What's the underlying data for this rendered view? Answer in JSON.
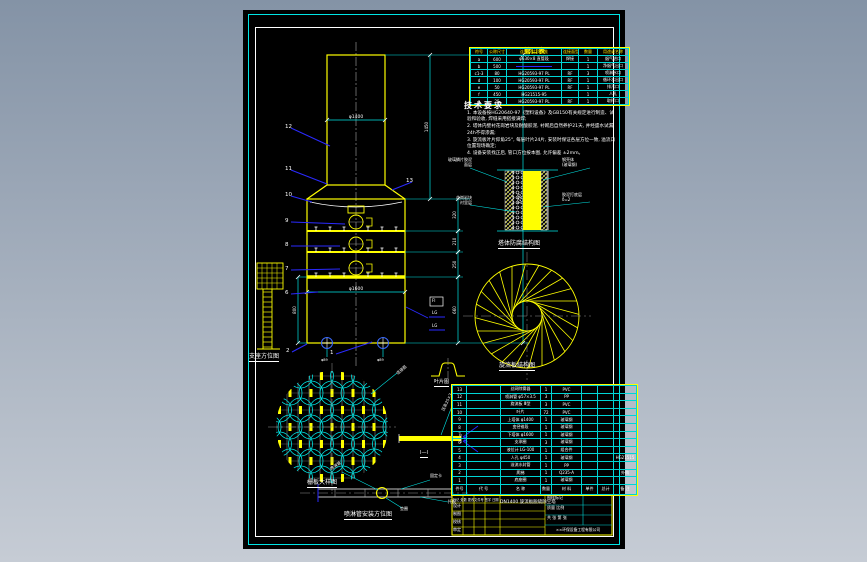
{
  "app": {
    "kind": "CAD drawing viewer",
    "sheet": "black drawing sheet with cyan/white frame"
  },
  "colors": {
    "line_yellow": "#ffff00",
    "line_cyan": "#00ffff",
    "line_white": "#ffffff",
    "leader_blue": "#2a2aff",
    "centerline_gray": "#909090",
    "bg_top": "#8493a6",
    "bg_bottom": "#c6ccd5"
  },
  "nozzle_table": {
    "title": "管口表",
    "headers": [
      "符号",
      "公称尺寸",
      "连接尺寸、标准",
      "连接面型式",
      "数量",
      "用途或名称"
    ],
    "rows": [
      [
        "a",
        "600",
        "φ630×8 直管段",
        "焊接",
        "1",
        "烟气进口"
      ],
      [
        "b",
        "500",
        "——",
        "",
        "1",
        "净烟气出口"
      ],
      [
        "c1-3",
        "80",
        "HG20593-97 PL",
        "RF",
        "3",
        "喷淋水口"
      ],
      [
        "d",
        "100",
        "HG20593-97 PL",
        "RF",
        "1",
        "循环水出口"
      ],
      [
        "e",
        "50",
        "HG20593-97 PL",
        "RF",
        "1",
        "排污口"
      ],
      [
        "f",
        "450",
        "HG21515-95",
        "",
        "1",
        "人孔"
      ],
      [
        "g",
        "25",
        "HG20593-97 PL",
        "RF",
        "1",
        "取样口"
      ]
    ]
  },
  "notes": {
    "title": "技术要求",
    "items": [
      "1. 本设备按HG20640-97《塑料设备》及GB150有关规定进行制造、试验和验收, 焊缝采用搭接满焊;",
      "2. 塔体内壁衬花岗岩块及耐酸胶泥, 衬砌后自然养护21天, 并经盛水试漏24h不得渗漏;",
      "3. 旋流板叶片仰角25°, 每层叶片24片, 安装时保证各层方位一致, 溢流口位置现场确定;",
      "4. 设备安装找正后, 管口方位按本图, 允许偏差 ±2mm。"
    ]
  },
  "lining_detail": {
    "caption": "塔体防腐结构图",
    "labels": [
      "玻璃鳞片胶泥,面层",
      "花岗岩块,衬里层",
      "钢壳体,(玻璃钢)",
      "胶泥打底层,δ=2"
    ]
  },
  "swirl": {
    "caption": "旋流板结构图",
    "blade_count": 24
  },
  "grid_plate": {
    "caption": "栅板大样图",
    "leader_label": "连接筋"
  },
  "vane_detail": {
    "caption": "叶片图"
  },
  "bar_detail": {
    "caption": "Ⅰ—Ⅰ",
    "leader_label": "压条25×3"
  },
  "pipe_detail": {
    "caption": "喷淋管安装方位图",
    "labels": {
      "upper_left": "喷淋管",
      "upper_right": "固定卡",
      "lower_right": "托板",
      "lower_left": "垫圈"
    }
  },
  "tower": {
    "base_caption": "支座方位图",
    "tags": [
      "FI",
      "LG",
      "LG"
    ],
    "leaders": [
      {
        "label": "12",
        "x": 285,
        "y": 124,
        "tx": 330,
        "ty": 146
      },
      {
        "label": "11",
        "x": 285,
        "y": 166,
        "tx": 327,
        "ty": 184
      },
      {
        "label": "10",
        "x": 285,
        "y": 192,
        "tx": 312,
        "ty": 202
      },
      {
        "label": "9",
        "x": 285,
        "y": 218,
        "tx": 345,
        "ty": 224
      },
      {
        "label": "8",
        "x": 285,
        "y": 242,
        "tx": 340,
        "ty": 246
      },
      {
        "label": "7",
        "x": 285,
        "y": 266,
        "tx": 340,
        "ty": 269
      },
      {
        "label": "6",
        "x": 285,
        "y": 290,
        "tx": 318,
        "ty": 292
      },
      {
        "label": "13",
        "x": 406,
        "y": 178,
        "tx": 392,
        "ty": 190
      },
      {
        "label": "2",
        "x": 286,
        "y": 348,
        "tx": 307,
        "ty": 344
      },
      {
        "label": "1",
        "x": 330,
        "y": 350,
        "tx": 372,
        "ty": 342
      }
    ],
    "vertical_dims": [
      {
        "v": "320",
        "x": 458,
        "y1": 199,
        "y2": 231
      },
      {
        "v": "210",
        "x": 458,
        "y1": 231,
        "y2": 252
      },
      {
        "v": "250",
        "x": 458,
        "y1": 252,
        "y2": 277
      },
      {
        "v": "660",
        "x": 458,
        "y1": 277,
        "y2": 343
      },
      {
        "v": "1450",
        "x": 430,
        "y1": 55,
        "y2": 199
      },
      {
        "v": "7250",
        "x": 523,
        "y1": 55,
        "y2": 343
      },
      {
        "v": "800",
        "x": 298,
        "y1": 277,
        "y2": 343
      }
    ],
    "horizontal_dims": [
      {
        "v": "φ1400",
        "x1": 327,
        "x2": 385,
        "y": 120
      },
      {
        "v": "φ1600",
        "x1": 307,
        "x2": 405,
        "y": 292
      }
    ],
    "base_nozzle_dims": [
      "φ89",
      "φ89"
    ]
  },
  "bom": {
    "headers": [
      "件号",
      "代 号",
      "名  称",
      "数量",
      "材 料",
      "单件",
      "总计",
      "备 注"
    ],
    "rows": [
      [
        "13",
        "",
        "丝网除雾器",
        "1",
        "PVC",
        "",
        "",
        ""
      ],
      [
        "12",
        "",
        "喷淋管 φ57×3.5",
        "3",
        "PP",
        "",
        "",
        ""
      ],
      [
        "11",
        "",
        "旋流板 Ⅲ型",
        "3",
        "PVC",
        "",
        "",
        ""
      ],
      [
        "10",
        "",
        "叶片",
        "72",
        "PVC",
        "",
        "",
        ""
      ],
      [
        "9",
        "",
        "上塔体 φ1400",
        "1",
        "玻璃钢",
        "",
        "",
        ""
      ],
      [
        "8",
        "",
        "变径锥段",
        "1",
        "玻璃钢",
        "",
        "",
        ""
      ],
      [
        "7",
        "",
        "下塔体 φ1600",
        "1",
        "玻璃钢",
        "",
        "",
        ""
      ],
      [
        "6",
        "",
        "支承圈",
        "3",
        "玻璃钢",
        "",
        "",
        ""
      ],
      [
        "5",
        "",
        "液位计 LG-100",
        "1",
        "组合件",
        "",
        "",
        ""
      ],
      [
        "4",
        "",
        "人孔 φ450",
        "1",
        "玻璃钢",
        "",
        "",
        "HG21515"
      ],
      [
        "3",
        "",
        "溢流水封管",
        "1",
        "PP",
        "",
        "",
        ""
      ],
      [
        "2",
        "",
        "爬梯",
        "1",
        "Q235-A",
        "",
        "",
        "外购"
      ],
      [
        "1",
        "",
        "底座圈",
        "1",
        "玻璃钢",
        "",
        "",
        ""
      ]
    ]
  },
  "title_block": {
    "title": "DN1400 旋流板脱硫除尘塔",
    "company": "××环保设备工程有限公司",
    "top_row": "标记 处数 更改文件号 签字 日期",
    "left_rows": [
      "设计",
      "制图",
      "校核",
      "审定"
    ],
    "right_rows": [
      "图样标记",
      "质量  比例",
      "共 张  第 张"
    ]
  }
}
